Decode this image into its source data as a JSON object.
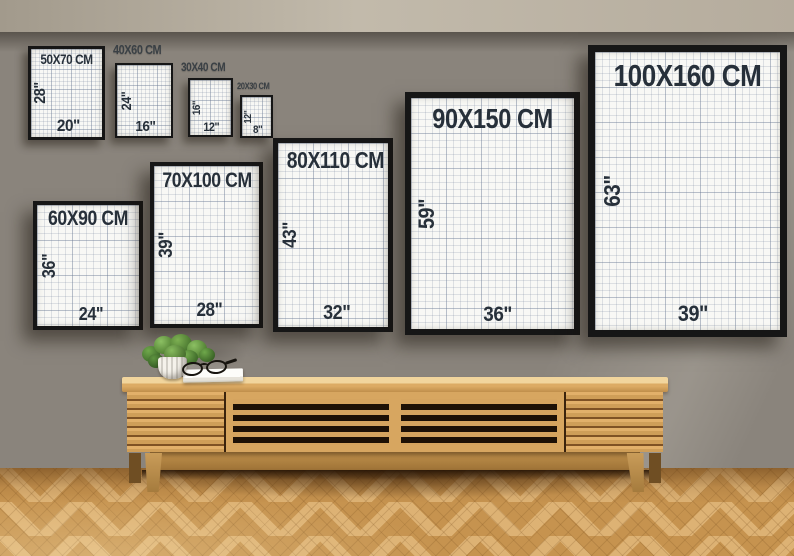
{
  "frames": [
    {
      "title": "50X70 CM",
      "height_label": "28\"",
      "width_label": "20\"",
      "title_placement": "inside"
    },
    {
      "title": "40X60 CM",
      "height_label": "24\"",
      "width_label": "16\"",
      "title_placement": "above"
    },
    {
      "title": "30X40 CM",
      "height_label": "16\"",
      "width_label": "12\"",
      "title_placement": "above"
    },
    {
      "title": "20X30 CM",
      "height_label": "12\"",
      "width_label": "8\"",
      "title_placement": "above"
    },
    {
      "title": "60X90 CM",
      "height_label": "36\"",
      "width_label": "24\"",
      "title_placement": "inside"
    },
    {
      "title": "70X100 CM",
      "height_label": "39\"",
      "width_label": "28\"",
      "title_placement": "inside"
    },
    {
      "title": "80X110 CM",
      "height_label": "43\"",
      "width_label": "32\"",
      "title_placement": "inside"
    },
    {
      "title": "90X150 CM",
      "height_label": "59\"",
      "width_label": "36\"",
      "title_placement": "inside"
    },
    {
      "title": "100X160 CM",
      "height_label": "63\"",
      "width_label": "39\"",
      "title_placement": "inside"
    }
  ],
  "colors": {
    "label_text": "#27303a",
    "wall_label_text": "#3a4045",
    "frame_border": "#161616",
    "paper": "#f8f8f5",
    "grid_line": "#6c7c96",
    "wall": "#857f76",
    "wood": "#d7a660",
    "floor": "#ddb274",
    "plant": "#568c37"
  }
}
